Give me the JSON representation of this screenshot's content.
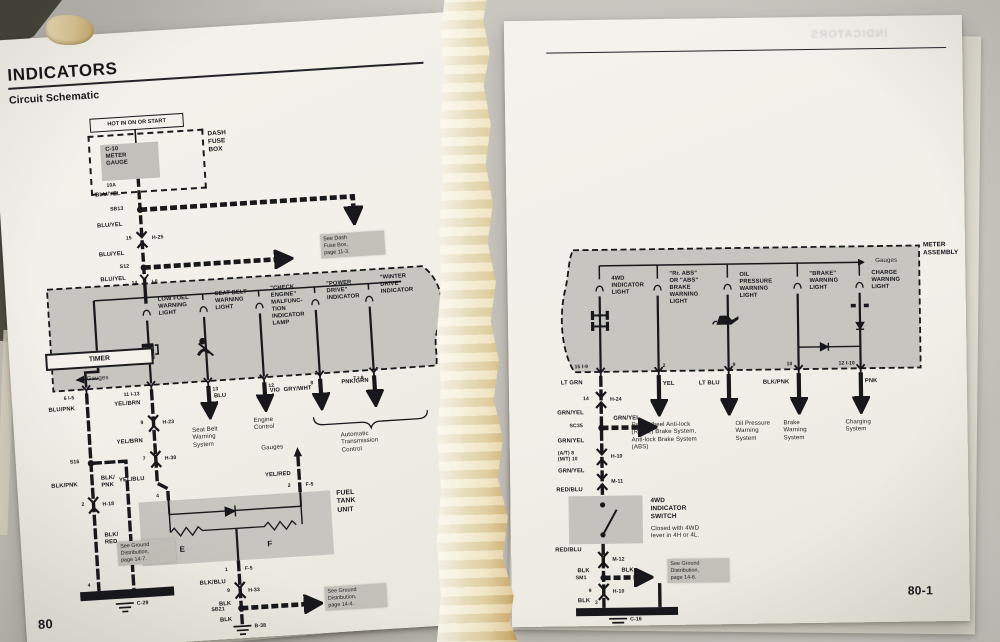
{
  "left": {
    "title": "INDICATORS",
    "subtitle": "Circuit Schematic",
    "page_number": "80",
    "power_label": "HOT IN ON OR START",
    "fuse_name": "C-10\nMETER\nGAUGE",
    "fuse_amps": "10A",
    "fuse_box_label": "DASH\nFUSE\nBOX",
    "feed_labels": [
      "BLU/YEL",
      "BLU/YEL",
      "BLU/YEL",
      "BLU/YEL"
    ],
    "splice_sb13": "SB13",
    "splice_s12": "S12",
    "conn_h25_pin": "15",
    "conn_h25": "H-25",
    "entry_pin": "14",
    "entry_conn": "I-8",
    "note_dash_fuse": "See Dash\nFuse Box,\npage 11-3.",
    "lamp_low_fuel": "LOW FUEL\nWARNING\nLIGHT",
    "lamp_seat_belt": "SEAT BELT\nWARNING\nLIGHT",
    "lamp_check_engine": "\"CHECK\nENGINE\"\nMALFUNC-\nTION\nINDICATOR\nLAMP",
    "lamp_power_drive": "\"POWER\nDRIVE\"\nINDICATOR",
    "lamp_winter_drive": "\"WINTER\nDRIVE\"\nINDICATOR",
    "timer_label": "TIMER",
    "gauges_left": "Gauges",
    "pins": {
      "p1": "6   I-5",
      "p2": "11   I-13",
      "p3": "13",
      "p4": "12",
      "p5": "8",
      "p6": "7   I-9"
    },
    "w_blupnk": "BLU/PNK",
    "splice_s16": "S16",
    "w_blkpnk": "BLK/PNK",
    "w_blkpnk2": "BLK/\nPNK",
    "h18_pin": "2",
    "h18": "H-18",
    "w_blkred": "BLK/\nRED",
    "note_ground_147": "See Ground\nDistribution,\npage 14-7.",
    "gnd_pin4": "4",
    "gnd_c29": "C-29",
    "w_yelbrn1": "YEL/BRN",
    "h23_pin": "9",
    "h23": "H-23",
    "w_yelbrn2": "YEL/BRN",
    "h30_pin": "7",
    "h30": "H-30",
    "w_yelblu": "YEL/BLU",
    "ftu_pin4": "4",
    "w_blu": "BLU",
    "sys_seat_belt": "Seat Belt\nWarning\nSystem",
    "w_vio": "VIO",
    "sys_engine": "Engine\nControl",
    "w_grywht": "GRY/WHT",
    "w_pnkgrn": "PNK/GRN",
    "sys_at": "Automatic\nTransmission\nControl",
    "gauges_right": "Gauges",
    "w_yelred": "YEL/RED",
    "f5_pin2": "2",
    "f5a": "F-5",
    "ftu_label": "FUEL\nTANK\nUNIT",
    "ftu_e": "E",
    "ftu_f": "F",
    "f5_pin1": "1",
    "f5b": "F-5",
    "w_blkblu": "BLK/BLU",
    "h33_pin": "9",
    "h33": "H-33",
    "w_blk1": "BLK",
    "splice_sb21": "SB21",
    "note_ground_144": "See Ground\nDistribution,\npage 14-4.",
    "w_blk2": "BLK",
    "gnd_b38": "B-38"
  },
  "right": {
    "ghost_title": "INDICATORS",
    "assembly_label": "METER\nASSEMBLY",
    "gauges": "Gauges",
    "lamp_4wd": "4WD\nINDICATOR\nLIGHT",
    "lamp_abs": "\"Rr. ABS\"\nOR \"ABS\"\nBRAKE\nWARNING\nLIGHT",
    "lamp_oil": "OIL\nPRESSURE\nWARNING\nLIGHT",
    "lamp_brake": "\"BRAKE\"\nWARNING\nLIGHT",
    "lamp_charge": "CHARGE\nWARNING\nLIGHT",
    "pins": {
      "p1": "15   I-9",
      "p2": "2",
      "p3": "9",
      "p4": "10",
      "p5": "12   I-10"
    },
    "w_ltgrn": "LT GRN",
    "h24_pin": "14",
    "h24": "H-24",
    "w_grnyel1": "GRN/YEL",
    "splice_sc35": "SC35",
    "w_grnyel_branch": "GRN/YEL",
    "w_grnyel2": "GRN/YEL",
    "h10a_pin": "(A/T) 8\n(M/T) 10",
    "h10a": "H-10",
    "w_grnyel3": "GRN/YEL",
    "m11": "M-11",
    "w_redblu1": "RED/BLU",
    "switch_label": "4WD\nINDICATOR\nSWITCH",
    "switch_desc": "Closed with 4WD\nlever in 4H or 4L.",
    "w_redblu2": "RED/BLU",
    "m12": "M-12",
    "w_blk1": "BLK",
    "splice_sm1": "SM1",
    "w_blk_branch": "BLK",
    "note_ground_146": "See Ground\nDistribution,\npage 14-6.",
    "h10b_pin": "9",
    "h10b": "H-10",
    "w_blk2": "BLK",
    "gnd_pin3": "3",
    "gnd_c16": "C-16",
    "w_yel": "YEL",
    "sys_rwal": "Rear Wheel Anti-lock\n(RWAL) Brake System,\nAnti-lock Brake System\n(ABS)",
    "w_ltblu": "LT BLU",
    "sys_oil": "Oil Pressure\nWarning\nSystem",
    "w_blkpnk": "BLK/PNK",
    "sys_brake": "Brake\nWarning\nSystem",
    "w_pnk": "PNK",
    "sys_charging": "Charging\nSystem",
    "page_number": "80-1"
  }
}
